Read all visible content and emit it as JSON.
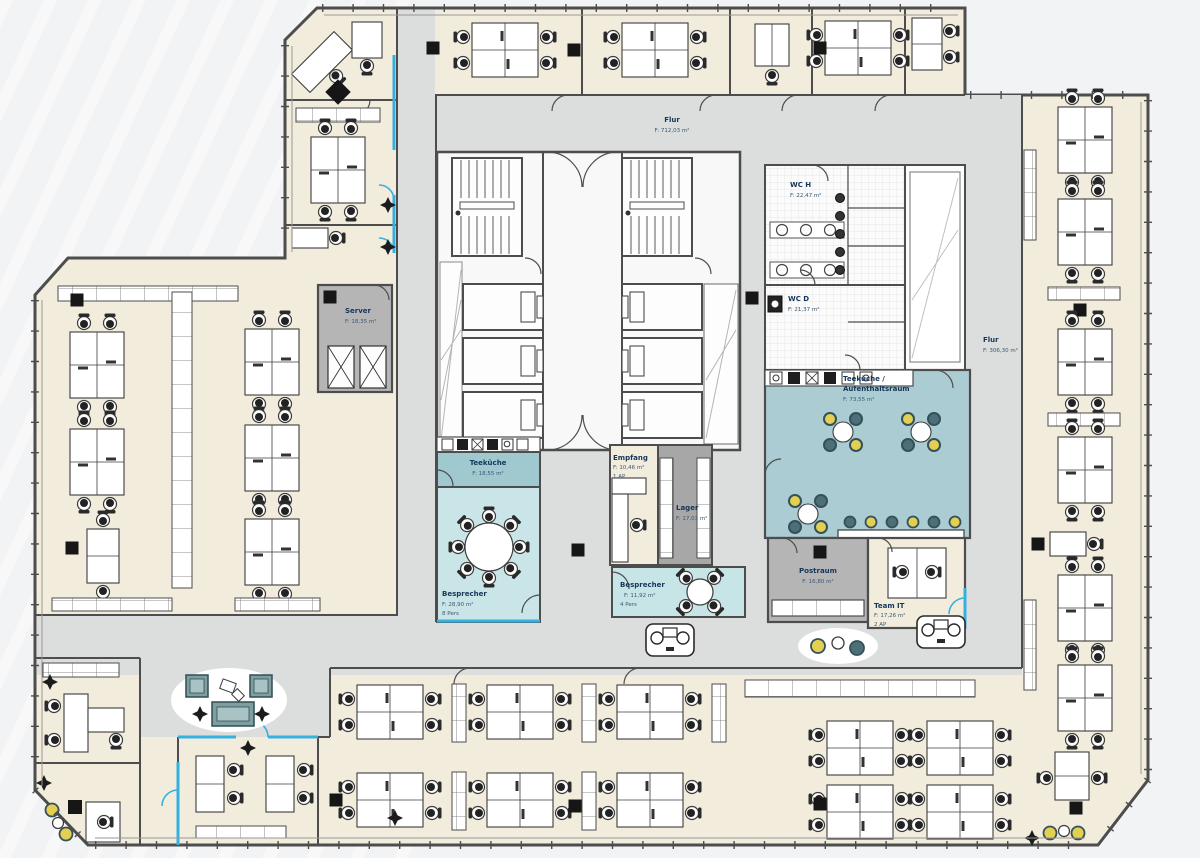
{
  "plan": {
    "type": "office-floor-plan",
    "accent_colors": {
      "room_fill": "#f1ecdc",
      "corridor": "#dcdddd",
      "meeting_teal": "#c9e5e7",
      "kitchen_teal": "#9fc8cf",
      "lounge_teal": "#abccd2",
      "service_gray": "#b5b5b5",
      "glass_wall_cyan": "#35b1e0",
      "chair_yellow": "#e3cf52",
      "chair_slate": "#4d6f77",
      "label_navy": "#16365a"
    },
    "rooms": {
      "flur_top": {
        "name": "Flur",
        "area": "F: 712,03 m²"
      },
      "flur_right": {
        "name": "Flur",
        "area": "F: 306,30 m²"
      },
      "server": {
        "name": "Server",
        "area": "F: 18,35 m²"
      },
      "teekueche": {
        "name": "Teeküche",
        "area": "F: 18,55 m²"
      },
      "besprecher_gross": {
        "name": "Besprecher",
        "area": "F: 28,90 m²",
        "cap": "8 Pers"
      },
      "empfang": {
        "name": "Empfang",
        "area": "F: 10,46 m²",
        "cap": "1 AP"
      },
      "lager": {
        "name": "Lager",
        "area": "F: 17,03 m²"
      },
      "besprecher_klein": {
        "name": "Besprecher",
        "area": "F: 11,92 m²",
        "cap": "4 Pers"
      },
      "wc_h": {
        "name": "WC H",
        "area": "F: 22,47 m²"
      },
      "wc_d": {
        "name": "WC D",
        "area": "F: 21,37 m²"
      },
      "aufenthaltsraum": {
        "name_line1": "Teeküche /",
        "name_line2": "Aufenthaltsraum",
        "area": "F: 73,55 m²"
      },
      "postraum": {
        "name": "Postraum",
        "area": "F: 16,80 m²"
      },
      "team_it": {
        "name": "Team IT",
        "area": "F: 17,26 m²",
        "cap": "2 AP"
      }
    }
  }
}
